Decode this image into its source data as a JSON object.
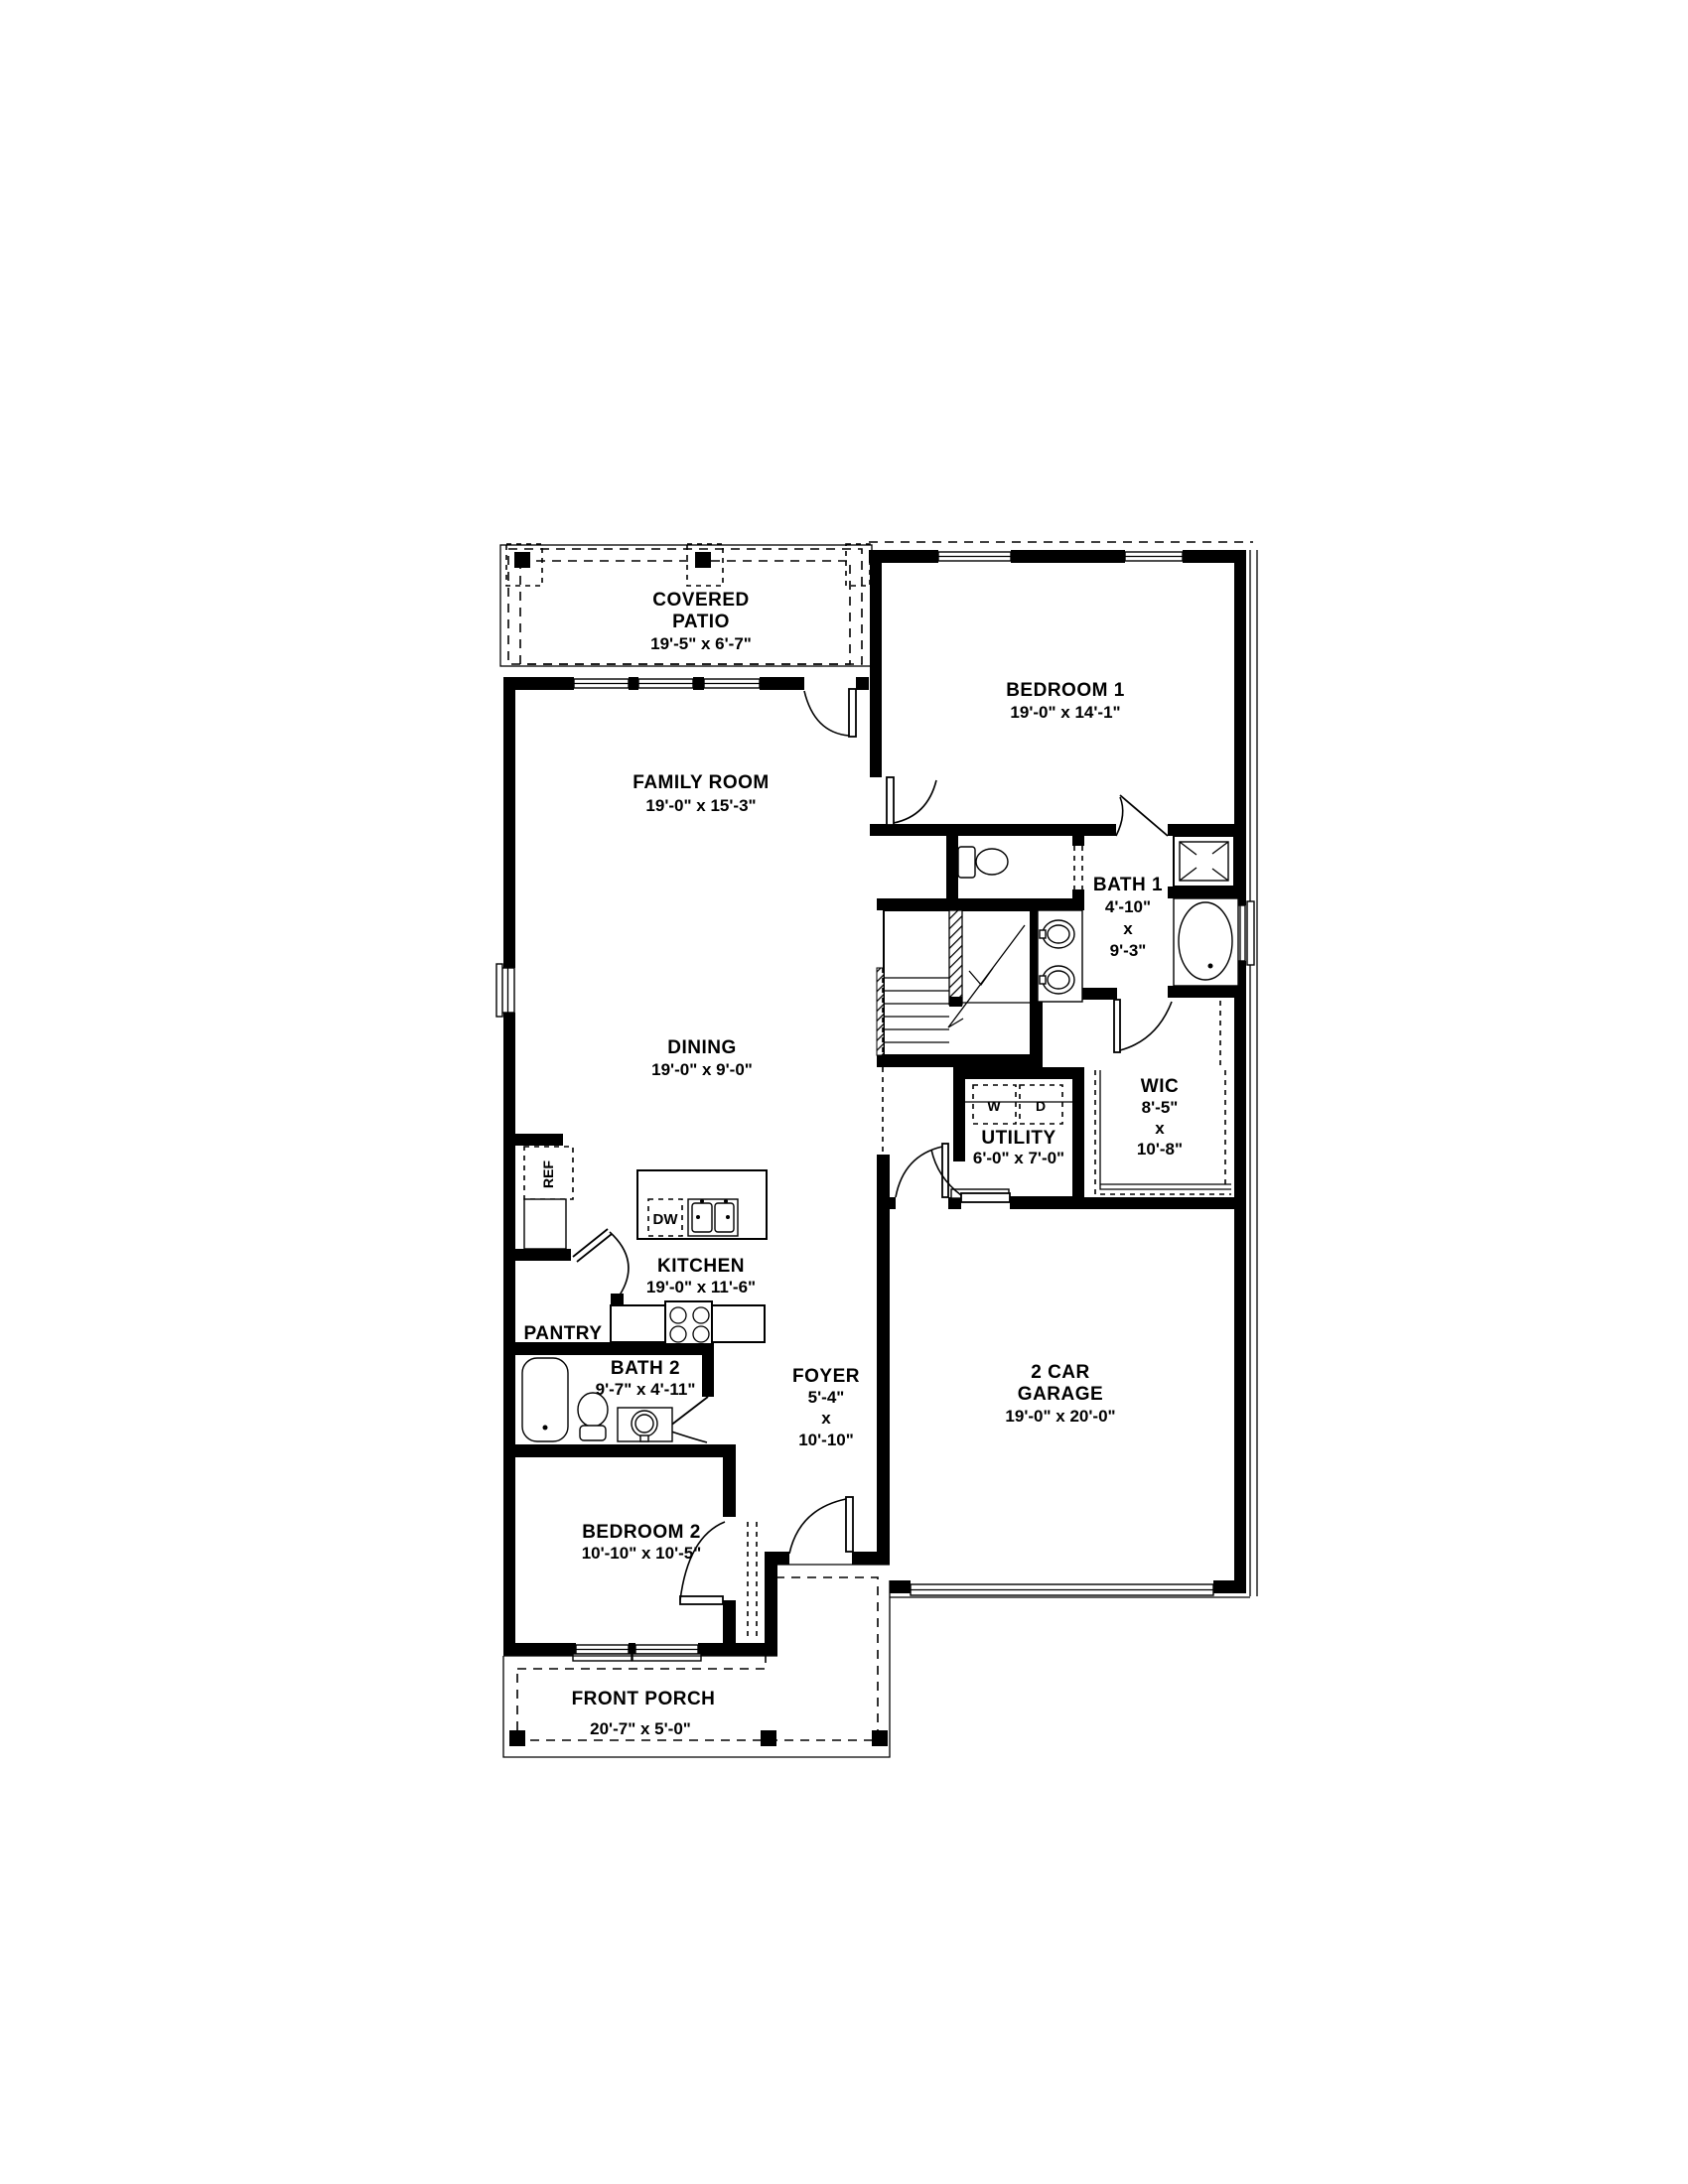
{
  "rooms": {
    "covered_patio": {
      "name_line1": "COVERED",
      "name_line2": "PATIO",
      "dims": "19'-5\" x 6'-7\""
    },
    "family_room": {
      "name": "FAMILY ROOM",
      "dims": "19'-0\" x 15'-3\""
    },
    "bedroom1": {
      "name": "BEDROOM 1",
      "dims": "19'-0\" x 14'-1\""
    },
    "bath1": {
      "name": "BATH 1",
      "dim_width": "4'-10\"",
      "dim_sep": "x",
      "dim_height": "9'-3\""
    },
    "dining": {
      "name": "DINING",
      "dims": "19'-0\" x 9'-0\""
    },
    "wic": {
      "name": "WIC",
      "dim_width": "8'-5\"",
      "dim_sep": "x",
      "dim_height": "10'-8\""
    },
    "utility": {
      "name": "UTILITY",
      "dims": "6'-0\" x 7'-0\""
    },
    "kitchen": {
      "name": "KITCHEN",
      "dims": "19'-0\" x 11'-6\""
    },
    "pantry": {
      "name": "PANTRY"
    },
    "bath2": {
      "name": "BATH 2",
      "dims": "9'-7\" x 4'-11\""
    },
    "foyer": {
      "name": "FOYER",
      "dim_width": "5'-4\"",
      "dim_sep": "x",
      "dim_height": "10'-10\""
    },
    "garage": {
      "name_line1": "2 CAR",
      "name_line2": "GARAGE",
      "dims": "19'-0\" x 20'-0\""
    },
    "bedroom2": {
      "name": "BEDROOM 2",
      "dims": "10'-10\" x 10'-5\""
    },
    "front_porch": {
      "name": "FRONT PORCH",
      "dims": "20'-7\" x 5'-0\""
    }
  },
  "appliances": {
    "refrigerator": "REF",
    "dishwasher": "DW",
    "washer": "W",
    "dryer": "D"
  },
  "colors": {
    "line": "#000000",
    "background": "#ffffff"
  }
}
